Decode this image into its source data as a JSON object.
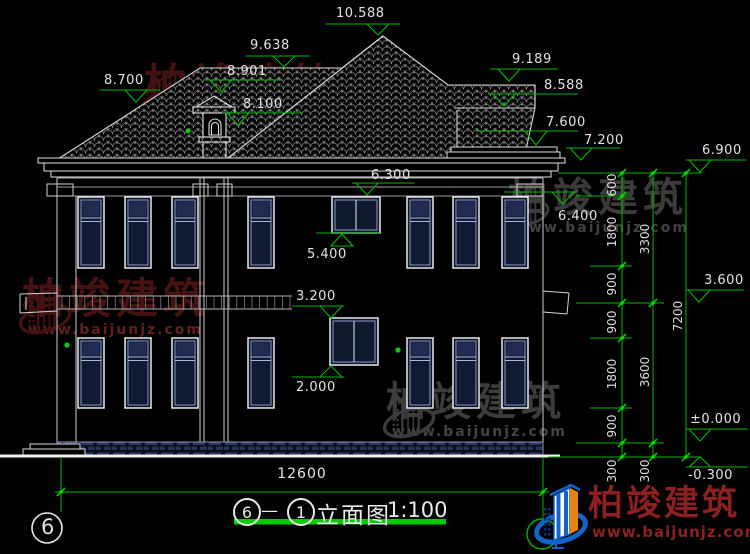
{
  "title": {
    "bubble_left": "6",
    "dash": "—",
    "bubble_right": "1",
    "label": "立面图",
    "scale": "1:100"
  },
  "grid_bubble_left": "6",
  "dimensions": {
    "overall_width": {
      "v": "12600",
      "x": 302,
      "y": 466
    },
    "vertical_chain": [
      {
        "v": "600",
        "x": 612,
        "y": 185
      },
      {
        "v": "1800",
        "x": 612,
        "y": 232
      },
      {
        "v": "900",
        "x": 612,
        "y": 284
      },
      {
        "v": "900",
        "x": 612,
        "y": 322
      },
      {
        "v": "1800",
        "x": 612,
        "y": 374
      },
      {
        "v": "900",
        "x": 612,
        "y": 426
      },
      {
        "v": "300",
        "x": 612,
        "y": 471
      },
      {
        "v": "3300",
        "x": 645,
        "y": 239
      },
      {
        "v": "3600",
        "x": 645,
        "y": 372
      },
      {
        "v": "300",
        "x": 645,
        "y": 471
      },
      {
        "v": "7200",
        "x": 678,
        "y": 316
      }
    ]
  },
  "levels": [
    {
      "v": "10.588",
      "tx": 336,
      "ty": 6,
      "x1": 325,
      "x2": 400,
      "ly": 24,
      "by": 24,
      "ax": 378,
      "ay": 35
    },
    {
      "v": "9.638",
      "tx": 250,
      "ty": 38,
      "x1": 246,
      "x2": 310,
      "ly": 56,
      "by": 56,
      "ax": 284,
      "ay": 67
    },
    {
      "v": "8.901",
      "tx": 227,
      "ty": 64,
      "x1": 204,
      "x2": 282,
      "ly": 80,
      "by": 80,
      "ax": 221,
      "ay": 92
    },
    {
      "v": "8.100",
      "tx": 243,
      "ty": 97,
      "x1": 222,
      "x2": 302,
      "ly": 113,
      "by": 113,
      "ax": 238,
      "ay": 125
    },
    {
      "v": "8.700",
      "tx": 104,
      "ty": 73,
      "x1": 100,
      "x2": 160,
      "ly": 90,
      "by": 90,
      "ax": 136,
      "ay": 102
    },
    {
      "v": "9.189",
      "tx": 512,
      "ty": 52,
      "x1": 490,
      "x2": 558,
      "ly": 69,
      "by": 69,
      "ax": 509,
      "ay": 81
    },
    {
      "v": "8.588",
      "tx": 544,
      "ty": 78,
      "x1": 488,
      "x2": 578,
      "ly": 94,
      "by": 94,
      "ax": 504,
      "ay": 106
    },
    {
      "v": "7.600",
      "tx": 546,
      "ty": 115,
      "x1": 476,
      "x2": 578,
      "ly": 131,
      "by": 131,
      "ax": 536,
      "ay": 145
    },
    {
      "v": "7.200",
      "tx": 584,
      "ty": 133,
      "x1": 566,
      "x2": 620,
      "ly": 148,
      "by": 148,
      "ax": 581,
      "ay": 160
    },
    {
      "v": "6.900",
      "tx": 702,
      "ty": 143,
      "x1": 686,
      "x2": 746,
      "ly": 160,
      "by": 160,
      "ax": 700,
      "ay": 172
    },
    {
      "v": "6.300",
      "tx": 371,
      "ty": 168,
      "x1": 352,
      "x2": 414,
      "ly": 183,
      "by": 183,
      "ax": 367,
      "ay": 195
    },
    {
      "v": "6.400",
      "tx": 558,
      "ty": 209,
      "x1": 504,
      "x2": 578,
      "ly": 192,
      "by": 192,
      "ax": 563,
      "ay": 204
    },
    {
      "v": "5.400",
      "tx": 307,
      "ty": 247,
      "x1": 316,
      "x2": 380,
      "ly": 233,
      "by": 246,
      "ax": 342,
      "ay": 234
    },
    {
      "v": "3.200",
      "tx": 296,
      "ty": 289,
      "x1": 292,
      "x2": 344,
      "ly": 306,
      "by": 306,
      "ax": 331,
      "ay": 318
    },
    {
      "v": "2.000",
      "tx": 296,
      "ty": 380,
      "x1": 292,
      "x2": 344,
      "ly": 377,
      "by": 377,
      "ax": 331,
      "ay": 366
    },
    {
      "v": "3.600",
      "tx": 704,
      "ty": 273,
      "x1": 686,
      "x2": 744,
      "ly": 290,
      "by": 290,
      "ax": 699,
      "ay": 302
    },
    {
      "v": "±0.000",
      "tx": 690,
      "ty": 412,
      "x1": 686,
      "x2": 748,
      "ly": 429,
      "by": 429,
      "ax": 700,
      "ay": 441
    },
    {
      "v": "-0.300",
      "tx": 688,
      "ty": 468,
      "x1": 686,
      "x2": 748,
      "ly": 467,
      "by": 467,
      "ax": 700,
      "ay": 457
    }
  ],
  "watermarks": [
    {
      "brand": "柏竣建筑",
      "url": "www.baijunjz.com",
      "x": 138,
      "y": 64,
      "logo": 56,
      "char": 44,
      "color": "#4a1414",
      "url_color": "#564040"
    },
    {
      "brand": "柏竣建筑",
      "url": "www.baijunjz.com",
      "x": 16,
      "y": 278,
      "logo": 58,
      "char": 42,
      "color": "#4d1515",
      "url_color": "#6b2424"
    },
    {
      "brand": "柏竣建筑",
      "url": "www.baijunjz.com",
      "x": 502,
      "y": 178,
      "logo": 50,
      "char": 40,
      "color": "#424242",
      "url_color": "#4a4a4a"
    },
    {
      "brand": "柏竣建筑",
      "url": "www.baijunjz.com",
      "x": 380,
      "y": 382,
      "logo": 58,
      "char": 40,
      "color": "#434343",
      "url_color": "#4c4c4c"
    }
  ],
  "logo": {
    "brand": "柏竣建筑",
    "url": "www.baijunjz.com"
  },
  "colors": {
    "annotation_green": "#00b400",
    "underline_green": "#00cc00",
    "cad_white": "#e8e8e8",
    "glass_navy": "#111a33",
    "frame_blue": "#8a97c8",
    "logo_blue": "#1464c8",
    "logo_orange": "#e8820c",
    "brand_red": "#8b2020"
  }
}
